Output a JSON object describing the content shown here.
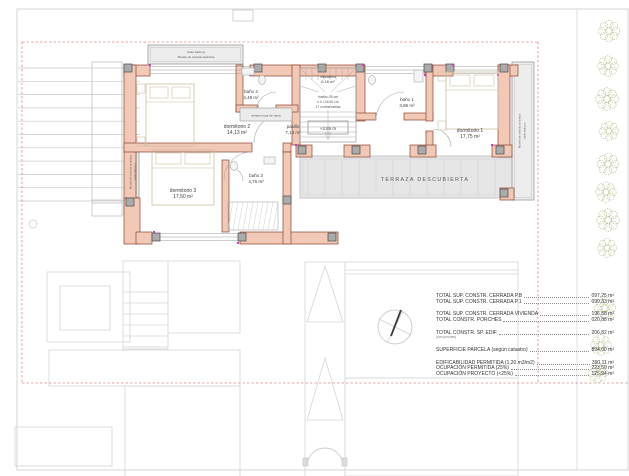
{
  "drawing_type": "first floor architectural plan",
  "rooms": [
    {
      "name": "dormitorio 2",
      "area": "14,13 m²"
    },
    {
      "name": "baño 2",
      "area": "4,49 m²"
    },
    {
      "name": "pasillo",
      "area": "7,13 m²"
    },
    {
      "name": "baño 1",
      "area": "3,86 m²"
    },
    {
      "name": "dormitorio 1",
      "area": "17,75 m²"
    },
    {
      "name": "dormitorio 3",
      "area": "17,50 m²"
    },
    {
      "name": "baño 3",
      "area": "4,76 m²"
    }
  ],
  "stairs": {
    "label": "escalera",
    "area": "6,16 m²",
    "notes": [
      "huella=28 cm",
      "c.h.=18,50 cm",
      "17 contrahuellas"
    ]
  },
  "annotations": {
    "balcony_top": [
      "Juliet balcony",
      "Murete de celosía cerámica"
    ],
    "screen": [
      "Murete de celosía cerámica",
      "Juliet balcony"
    ],
    "closet": "armario ropa de cama",
    "level": "+3,85 m",
    "terrace": "TERRAZA DESCUBIERTA"
  },
  "summary": {
    "rows": [
      {
        "label": "TOTAL SUP. CONSTR. CERRADA P.B",
        "value": "097,25 m²"
      },
      {
        "label": "TOTAL SUP. CONSTR. CERRADA P.1",
        "value": "099,33 m²"
      },
      {
        "label": "TOTAL SUP. CONSTR. CERRADA VIVIENDA",
        "value": "196,58 m²"
      },
      {
        "label": "TOTAL CONSTR. PORCHES",
        "value": "020,88 m²"
      },
      {
        "label": "TOTAL CONSTR. SP. EDIF",
        "sub": "(con porches)",
        "value": "206,82 m²"
      },
      {
        "label": "SUPERFICIE PARCELA (según catastro)",
        "value": "894,00 m²"
      },
      {
        "label": "EDIFICABILIDAD PERMITIDA (1,20 m3/m2)",
        "value": "390,11 m²"
      },
      {
        "label": "OCUPACIÓN PERMITIDA (25%)",
        "value": "223,50 m²"
      },
      {
        "label": "OCUPACIÓN PROYECTO (<25%)",
        "value": "125,94 m²"
      }
    ]
  },
  "icons": {
    "north_arrow": "compass circle with needle",
    "tree": "scribbled shrub symbol",
    "stair_direction": "down arrow"
  },
  "colors": {
    "wall_fill": "#f2c9b7",
    "wall_stroke": "#8a4433",
    "boundary_dash": "#e08a8a",
    "vegetation": "#b7bb8b",
    "terrace_fill": "#e6e6e6",
    "column_fill": "#ababab",
    "snap_dot": "#c83cc8"
  }
}
